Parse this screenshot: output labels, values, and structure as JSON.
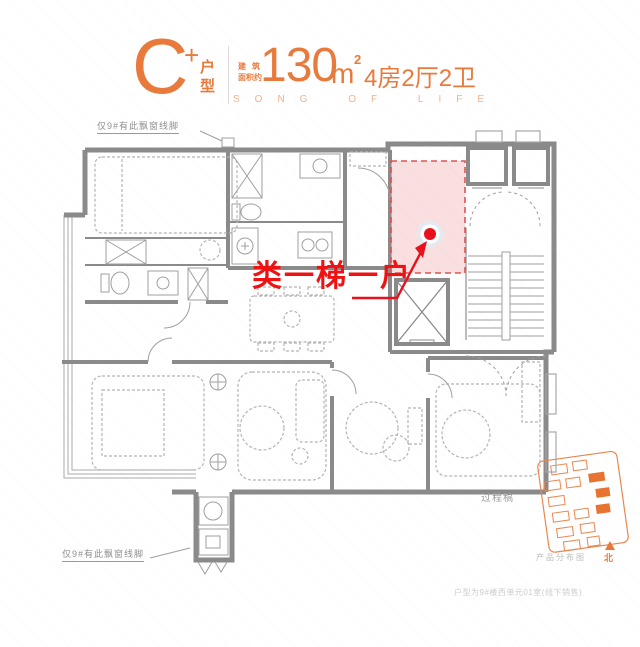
{
  "header": {
    "unit_letter": "C",
    "unit_plus": "+",
    "unit_type": "户\n型",
    "area_prefix_line1": "建筑",
    "area_prefix_line2": "面积约",
    "area_value": "130",
    "area_unit": "m",
    "area_exponent": "2",
    "layout_summary": "4房2厅2卫",
    "tagline": "SONG OF LIFE"
  },
  "plan": {
    "highlight_callout": "类一梯一户",
    "annotation_top_left": "仅9#有此飘窗线脚",
    "annotation_bottom_left": "仅9#有此飘窗线脚",
    "watermark": "过程稿"
  },
  "site_map": {
    "caption": "产品分布图",
    "north_label": "北"
  },
  "footer": {
    "disclaimer": "户型为9#楼西单元01室(线下销售)"
  },
  "colors": {
    "accent_orange": "#E87A3C",
    "light_orange": "#F2B28C",
    "callout_red": "#EE1212",
    "marker_red": "#E8101C",
    "highlight_pink": "#F5CACA",
    "wall_gray": "#8A8A8A"
  }
}
